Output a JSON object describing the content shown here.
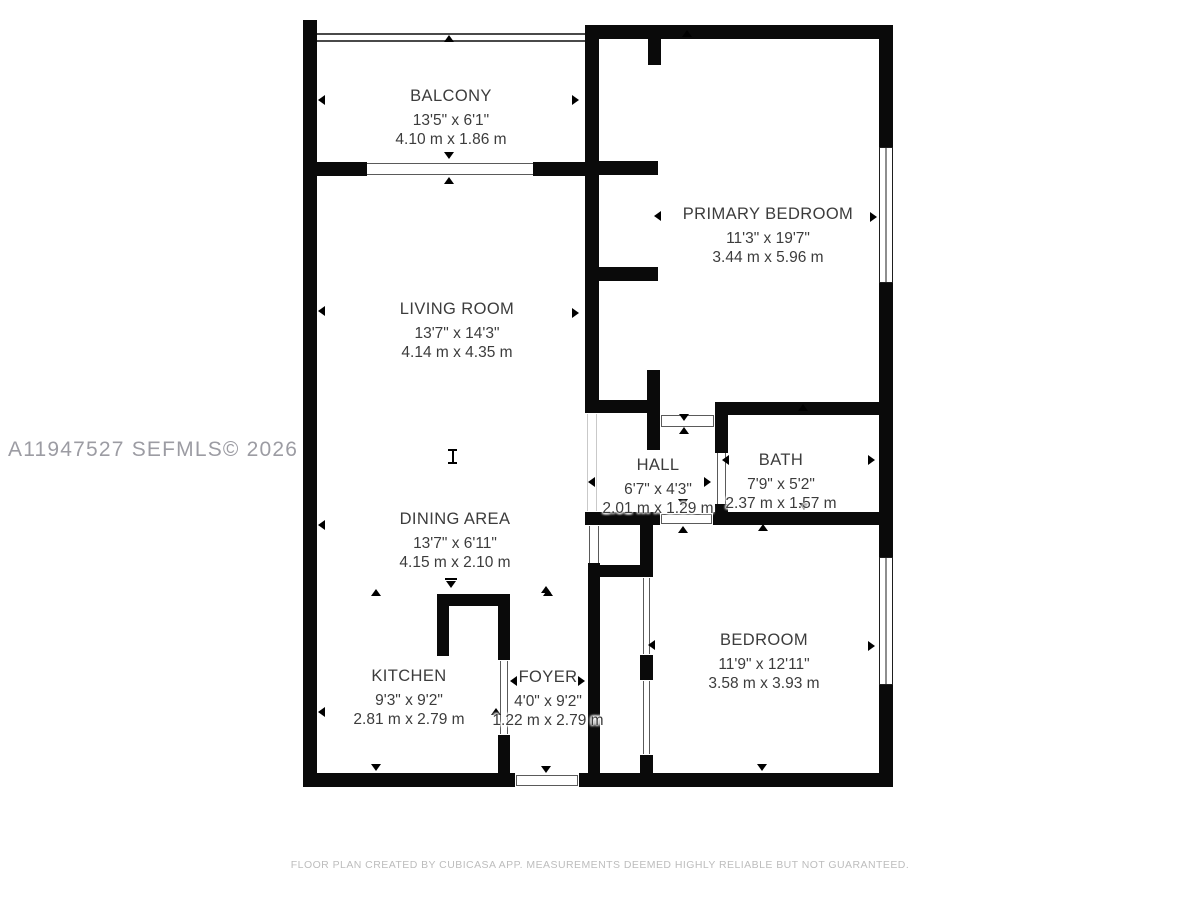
{
  "watermark": "A11947527  SEFMLS© 2026",
  "footer": "FLOOR PLAN CREATED BY CUBICASA APP. MEASUREMENTS DEEMED HIGHLY RELIABLE BUT NOT GUARANTEED.",
  "colors": {
    "wall": "#0a0a0a",
    "label_text": "#3c3c3c",
    "watermark_text": "#9c9ca3",
    "footer_text": "#bdbdbd",
    "background": "#ffffff"
  },
  "rooms": {
    "balcony": {
      "name": "BALCONY",
      "imperial": "13'5\" x 6'1\"",
      "metric": "4.10 m x 1.86 m"
    },
    "primary": {
      "name": "PRIMARY BEDROOM",
      "imperial": "11'3\" x 19'7\"",
      "metric": "3.44 m x 5.96 m"
    },
    "living": {
      "name": "LIVING ROOM",
      "imperial": "13'7\" x 14'3\"",
      "metric": "4.14 m x 4.35 m"
    },
    "hall": {
      "name": "HALL",
      "imperial": "6'7\" x 4'3\"",
      "metric": "2.01 m x 1.29 m"
    },
    "bath": {
      "name": "BATH",
      "imperial": "7'9\" x 5'2\"",
      "metric": "2.37 m x 1.57 m"
    },
    "dining": {
      "name": "DINING AREA",
      "imperial": "13'7\" x 6'11\"",
      "metric": "4.15 m x 2.10 m"
    },
    "kitchen": {
      "name": "KITCHEN",
      "imperial": "9'3\" x 9'2\"",
      "metric": "2.81 m x 2.79 m"
    },
    "foyer": {
      "name": "FOYER",
      "imperial": "4'0\" x 9'2\"",
      "metric": "1.22 m x 2.79 m"
    },
    "bedroom": {
      "name": "BEDROOM",
      "imperial": "11'9\" x 12'11\"",
      "metric": "3.58 m x 3.93 m"
    }
  }
}
